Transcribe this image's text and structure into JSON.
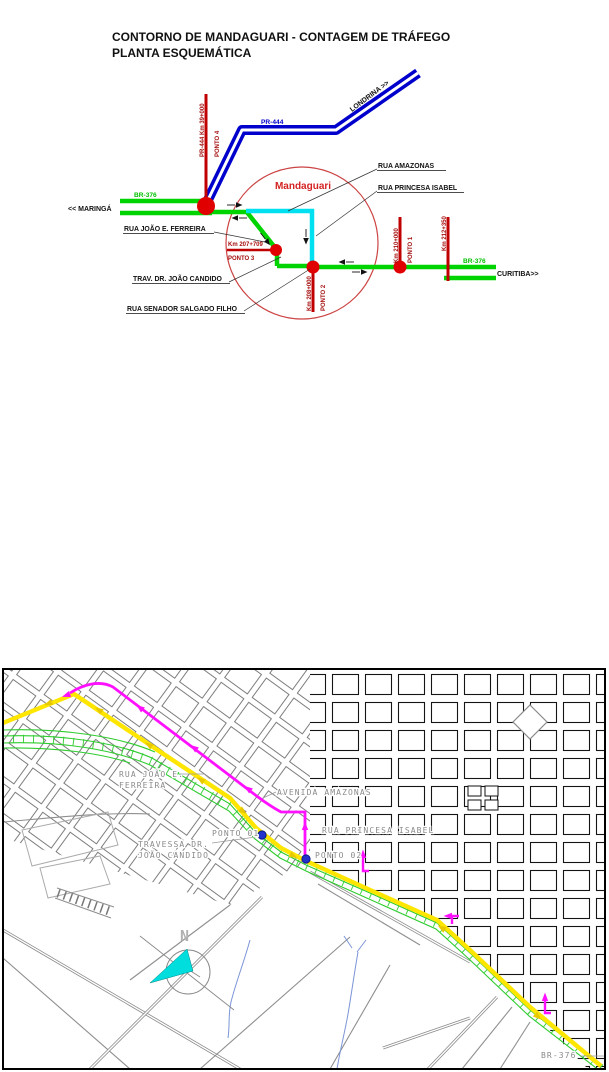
{
  "title": {
    "line1": "CONTORNO DE MANDAGUARI - CONTAGEM DE TRÁFEGO",
    "line2": "PLANTA ESQUEMÁTICA"
  },
  "schematic": {
    "city": "Mandaguari",
    "highways": {
      "pr444": "PR-444",
      "br376_west": "BR-376",
      "br376_east": "BR-376"
    },
    "destinations": {
      "west": "<< MARINGÁ",
      "northeast": "LONDRINA >>",
      "east": "CURITIBA>>"
    },
    "points": {
      "p4": {
        "km": "PR-444 Km 39+000",
        "name": "PONTO 4"
      },
      "p3": {
        "km": "Km 207+709",
        "name": "PONTO 3"
      },
      "p2": {
        "km": "Km 208+000",
        "name": "PONTO 2"
      },
      "p1": {
        "km": "Km 210+000",
        "name": "PONTO 1"
      }
    },
    "km_marker": "Km 212+350",
    "streets": {
      "amazonas": "RUA AMAZONAS",
      "princesa": "RUA PRINCESA ISABEL",
      "joao_ferreira": "RUA JOÃO E. FERREIRA",
      "trav_candido": "TRAV. DR. JOÃO CANDIDO",
      "salgado": "RUA SENADOR SALGADO FILHO"
    }
  },
  "map": {
    "labels": {
      "rua_joao_1": "RUA JOÃO E.",
      "rua_joao_2": "FERREIRA",
      "avenida_amazonas": "AVENIDA AMAZONAS",
      "rua_princesa": "RUA PRINCESA ISABEL",
      "travessa_1": "TRAVESSA DR.",
      "travessa_2": "JOÃO CANDIDO",
      "ponto01": "PONTO 01",
      "ponto02": "PONTO 02",
      "br376": "BR-376",
      "north": "N"
    }
  },
  "colors": {
    "highway_green": "#00d400",
    "highway_blue": "#0000cc",
    "route_cyan": "#00e0f0",
    "route_yellow": "#ffe600",
    "route_magenta": "#ff10ff",
    "marker_red": "#e00000",
    "km_line_red": "#c00000",
    "point_label_red": "#a50d0d",
    "city_circle_red": "#cc4444",
    "map_label_gray": "#8a8a8a",
    "count_dot_blue": "#2233cc",
    "stream_blue": "#7b95d6"
  }
}
